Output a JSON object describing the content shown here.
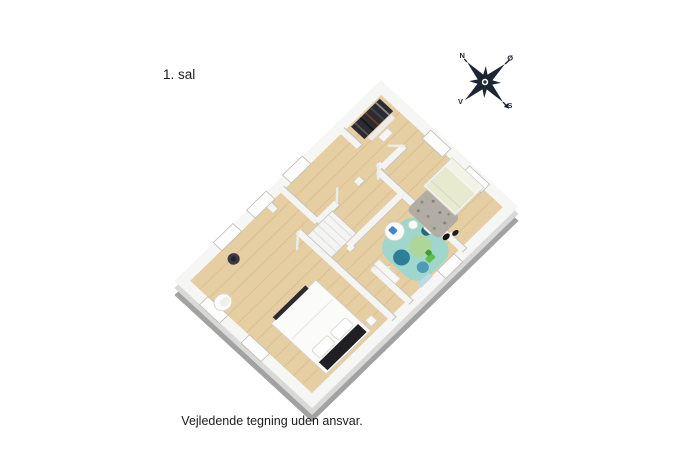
{
  "page": {
    "background": "#ffffff",
    "width": 687,
    "height": 457
  },
  "header": {
    "floor_label": "1. sal"
  },
  "footer": {
    "disclaimer": "Vejledende tegning uden ansvar."
  },
  "compass": {
    "labels": {
      "north": "N",
      "east": "Ø",
      "south": "S",
      "west": "V"
    },
    "color": "#1c2633",
    "rotation_deg": -42
  },
  "palette": {
    "wall_top": "#f6f6f4",
    "wall_face": "#dadad8",
    "plinth_gray": "#a2a2a2",
    "floor_wood_light": "#ead4ab",
    "floor_wood_dark": "#d8b88a",
    "rug_teal": "#9ad8cf",
    "rug_gray_speckled": "#b2ada4",
    "duvet_green": "#e8ead0",
    "headboard_black": "#202024",
    "accent_blue": "#3f86c9",
    "accent_green": "#63bd4e"
  },
  "floorplan": {
    "view": "3d-isometric-render",
    "rooms": [
      {
        "name": "bedroom-large",
        "furniture": [
          "double-bed",
          "armchair",
          "robot-vacuum"
        ]
      },
      {
        "name": "hallway-landing",
        "furniture": [
          "stair-opening"
        ]
      },
      {
        "name": "kids-room",
        "furniture": [
          "round-table",
          "stools",
          "teal-rug",
          "toy"
        ]
      },
      {
        "name": "walk-in-closet",
        "furniture": [
          "clothes-rack"
        ]
      },
      {
        "name": "bedroom-small",
        "furniture": [
          "single-bed",
          "gray-rug"
        ]
      }
    ]
  }
}
